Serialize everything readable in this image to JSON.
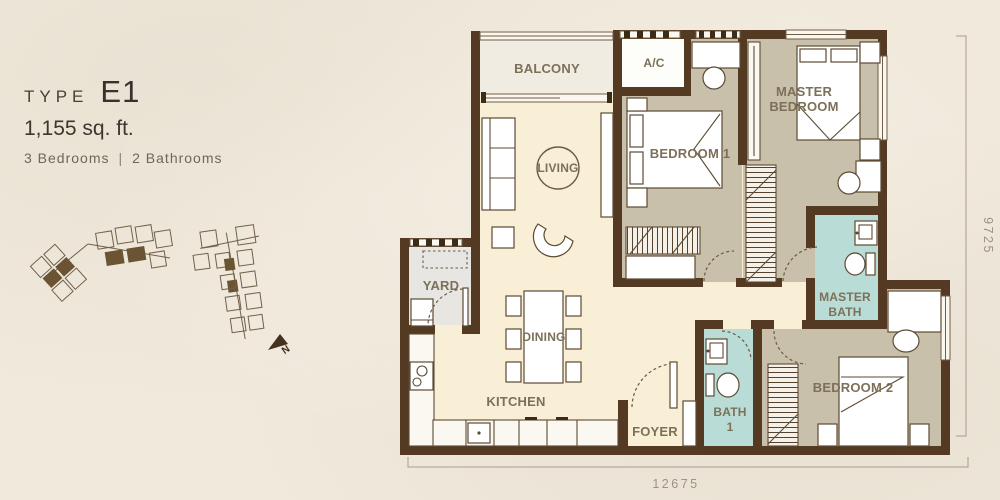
{
  "title": {
    "type_label": "TYPE",
    "type_code": "E1",
    "area": "1,155 sq. ft.",
    "bedrooms": "3 Bedrooms",
    "separator": "|",
    "bathrooms": "2 Bathrooms"
  },
  "plan": {
    "rooms": {
      "balcony": "BALCONY",
      "ac": "A/C",
      "living": "LIVING",
      "bedroom1": "BEDROOM 1",
      "master_bedroom": [
        "MASTER",
        "BEDROOM"
      ],
      "yard": "YARD",
      "dining": "DINING",
      "kitchen": "KITCHEN",
      "foyer": "FOYER",
      "bath1": [
        "BATH",
        "1"
      ],
      "master_bath": [
        "MASTER",
        "BATH"
      ],
      "bedroom2": "BEDROOM 2"
    },
    "dimensions": {
      "width_mm": "12675",
      "height_mm": "9725"
    },
    "colors": {
      "wall": "#543a22",
      "cream": "#f8efd6",
      "balcony": "#f1ece1",
      "taupe": "#c9c0ab",
      "teal": "#b9dcd6",
      "yard_gray": "#e8e6e2",
      "ac_white": "#fdfdf9",
      "label": "#7c7058",
      "dimension": "#9c9386"
    }
  },
  "compass": {
    "north_label": "N"
  }
}
